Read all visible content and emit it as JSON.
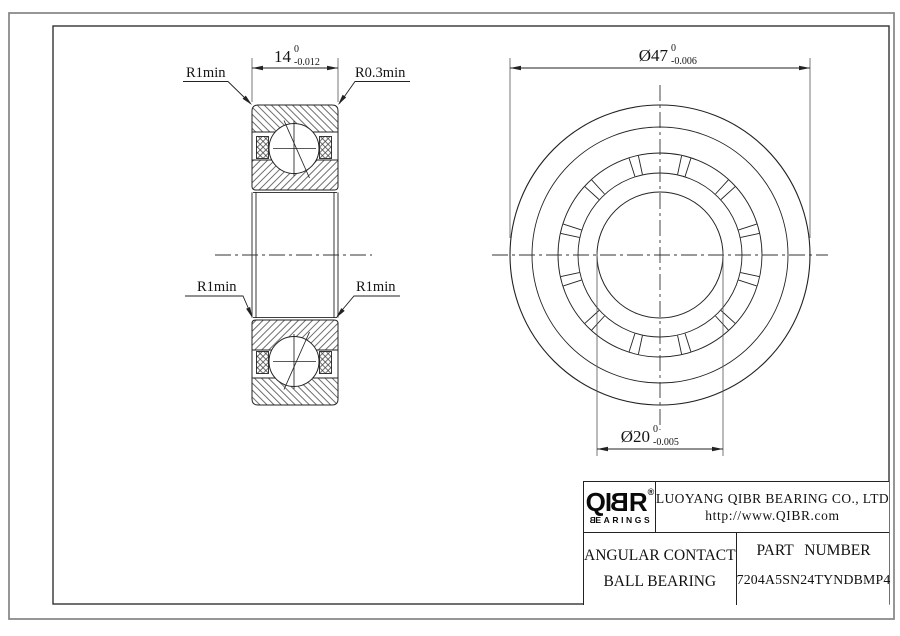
{
  "dims": {
    "width": {
      "value": "14",
      "tol_top": "0",
      "tol_bot": "-0.012"
    },
    "outer": {
      "value": "Ø47",
      "tol_top": "0",
      "tol_bot": "-0.006"
    },
    "bore": {
      "value": "Ø20",
      "tol_top": "0",
      "tol_bot": "-0.005"
    }
  },
  "labels": {
    "r1_top_left": "R1min",
    "r03_top_right": "R0.3min",
    "r1_mid_left": "R1min",
    "r1_mid_right": "R1min"
  },
  "title_block": {
    "logo_part1": "QI",
    "logo_part_b": "B",
    "logo_part2": "R",
    "registered": "®",
    "logo_sub_b": "B",
    "logo_sub_rest": "EARINGS",
    "company": "LUOYANG QIBR BEARING CO., LTD",
    "website": "http://www.QIBR.com",
    "product_line1": "ANGULAR CONTACT",
    "product_line2": "BALL BEARING",
    "part_label": "PART NUMBER",
    "part_number": "7204A5SN24TYNDBMP4"
  },
  "colors": {
    "line": "#222222",
    "frame": "#333333",
    "border": "#8a8a8a",
    "background": "#ffffff"
  }
}
